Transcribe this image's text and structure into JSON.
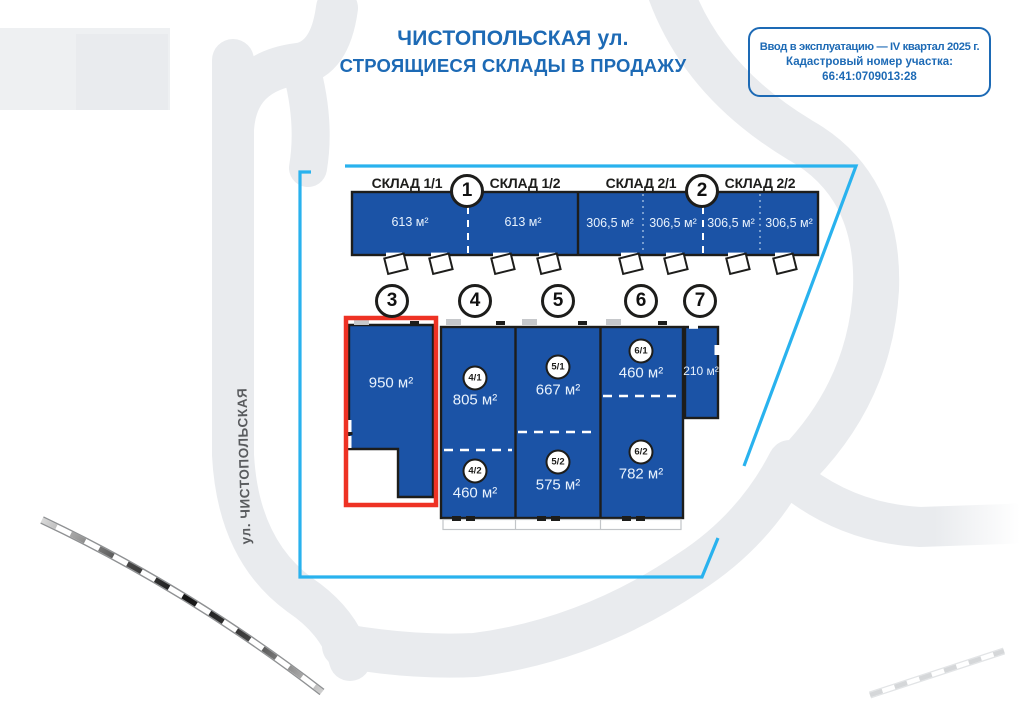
{
  "title": {
    "line1": "ЧИСТОПОЛЬСКАЯ ул.",
    "line2": "СТРОЯЩИЕСЯ СКЛАДЫ В ПРОДАЖУ"
  },
  "info_box": {
    "line1": "Ввод в эксплуатацию — IV квартал 2025 г.",
    "line2": "Кадастровый номер участка:",
    "line3": "66:41:0709013:28"
  },
  "street_label": "ул. ЧИСТОПОЛЬСКАЯ",
  "top_row": {
    "labels": [
      "СКЛАД 1/1",
      "СКЛАД 1/2",
      "СКЛАД 2/1",
      "СКЛАД 2/2"
    ],
    "numbers": [
      "1",
      "2"
    ],
    "areas": [
      "613 м²",
      "613 м²",
      "306,5 м²",
      "306,5 м²",
      "306,5 м²",
      "306,5 м²"
    ]
  },
  "bottom_row": {
    "numbers": [
      "3",
      "4",
      "5",
      "6",
      "7"
    ],
    "units": [
      {
        "badge": "",
        "area": "950 м²"
      },
      {
        "badge": "4/1",
        "area": "805 м²"
      },
      {
        "badge": "4/2",
        "area": "460 м²"
      },
      {
        "badge": "5/1",
        "area": "667 м²"
      },
      {
        "badge": "5/2",
        "area": "575 м²"
      },
      {
        "badge": "6/1",
        "area": "460 м²"
      },
      {
        "badge": "6/2",
        "area": "782 м²"
      },
      {
        "badge": "",
        "area": "210 м²"
      }
    ]
  },
  "colors": {
    "building_blue": "#1b53a6",
    "outline_dark": "#1d1d1b",
    "boundary_cyan": "#29b2ee",
    "highlight_red": "#ee3224",
    "brand_blue": "#1d6ab5",
    "road_gray": "#e9ebee",
    "rail_black": "#141414"
  }
}
